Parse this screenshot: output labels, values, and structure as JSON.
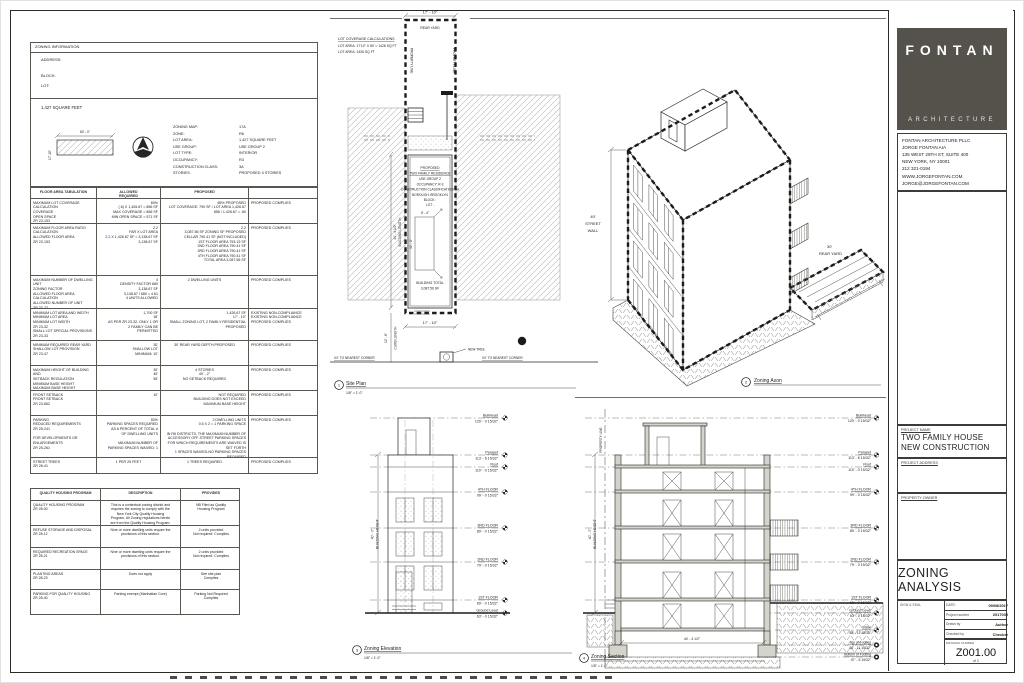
{
  "colors": {
    "logo_box": "#55524b",
    "line": "#2b2b29",
    "hatch": "#b9b9b6"
  },
  "title_block": {
    "logo_word": "FONTAN",
    "logo_sub": "ARCHITECTURE",
    "contact_lines": [
      "FONTAN ARCHITECTURE PLLC",
      "JORGE FONTAN AIA",
      "135 WEST 29TH ST, SUITE 400",
      "NEW YORK, NY 10001",
      "212 321-0194",
      "WWW.JORGEFONTAN.COM",
      "JORGE@JORGEFONTAN.COM"
    ],
    "project_name_label": "PROJECT NAME",
    "project_name1": "TWO FAMILY HOUSE",
    "project_name2": "NEW CONSTRUCTION",
    "project_address_label": "PROJECT ADDRESS",
    "property_owner_label": "PROPERTY OWNER",
    "sheet_title": "ZONING ANALYSIS",
    "seal_label": "SIGN & SEAL",
    "date_label": "DATE:",
    "date_value": "09/08/2017",
    "project_number_label": "Project number",
    "project_number_value": "2017030",
    "drawn_by_label": "Drawn by",
    "drawn_by_value": "Author",
    "checked_by_label": "Checked by",
    "checked_by_value": "Checker",
    "drawing_number_label": "DRAWING NUMBER",
    "drawing_number": "Z001.00",
    "sheet_of": "of 2"
  },
  "zoning_info": {
    "header": "ZONING INFORMATION",
    "address_label": "ADDRESS:",
    "block_label": "BLOCK:",
    "lot_label": "LOT:",
    "lot_area_title": "1,427 SQUARE FEET",
    "lot_dim_top": "80' - 0\"",
    "lot_dim_side": "17'-10\"",
    "fields": [
      {
        "label": "ZONING MAP:",
        "value": "17A"
      },
      {
        "label": "ZONE:",
        "value": "R6"
      },
      {
        "label": "LOT AREA:",
        "value": "1,427 SQUARE FEET"
      },
      {
        "label": "USE GROUP:",
        "value": "USE GROUP 2"
      },
      {
        "label": "LOT TYPE:",
        "value": "INTERIOR"
      },
      {
        "label": "OCCUPANCY:",
        "value": "R3"
      },
      {
        "label": "CONSTRUCTION CLASS:",
        "value": "3A"
      },
      {
        "label": "STORIES:",
        "value": "PROPOSED 4 STORIES"
      }
    ]
  },
  "floor_area_table": {
    "headers": [
      "FLOOR AREA TABULATION",
      "ALLOWED\nREQUIRED",
      "PROPOSED",
      ""
    ],
    "rows": [
      {
        "item": "MAXIMUM LOT COVERAGE\nCALCULATION\nCOVERAGE\nOPEN SPACE\nZR 23-153",
        "allowed": "60%\n(.6) X 1,426.67 = 856 SF\nMAX COVERAGE = 856 SF\nMIN OPEN SPACE = 571 SF",
        "proposed": "65% PROPOSED\nLOT COVERAGE: 790 SF / LOT AREA 1,426.67\n856 / 1,426.67 = .60",
        "status": "PROPOSED COMPLIES"
      },
      {
        "item": "MAXIMUM FLOOR AREA RATIO\nCALCULATION\nALLOWED FLOOR AREA\nZR 23-153",
        "allowed": "2.2\nFAR X LOT AREA\n2.2 X 1,426.67 SF = 3,138.67 SF\n3,138.67 SF",
        "proposed": "2.2\n3,087.56 SF ZONING SF PROPOSED\nCELLAR 790.41 SF (NOT INCLUDED)\n1ST FLOOR AREA 753.13 SF\n2ND FLOOR AREA 790.41 SF\n3RD FLOOR AREA 790.41 SF\n4TH FLOOR AREA 790.41 SF\nTOTAL AREA 3,087.56 SF",
        "status": "PROPOSED COMPLIES"
      },
      {
        "item": "MAXIMUM NUMBER OF DWELLING UNIT\nZONING FACTOR\nALLOWED FLOOR AREA\nCALCULATION\nALLOWED NUMBER OF UNIT\nZR 23-22",
        "allowed": "4\nDENSITY FACTOR 680\n3,138.67 SF\n3,138.67 / 680 = 4.61\n4 UNITS ALLOWED",
        "proposed": "2 DWELLING UNITS",
        "status": "PROPOSED COMPLIES"
      },
      {
        "item": "MINIMUM LOT AREA AND WIDTH\nMINIMUM LOT AREA\nMINIMUM LOT WIDTH\nZR 23-32\nSMALL LOT SPECIAL PROVISIONS\nZR 23-33",
        "allowed": "1,700 SF\n18'\nAS PER ZR 23-32, ONLY 1 OR\n2 FAMILY CAN BE\nPERMITTED",
        "proposed": "1,426.67 SF\n17' - 10\"\nSMALL ZONING LOT, 2 FAMILY RESIDENTIAL\nPROPOSED",
        "status": "EXISTING NON-COMPLIANCE\nEXISTING NON-COMPLIANCE\nPROPOSED COMPLIES"
      },
      {
        "item": "MINIMUM REQUIRED REAR YARD\nSHALLOW LOT PROVISION\nZR 23-47",
        "allowed": "30'\nSHALLOW LOT\nMINIMUM: 10'",
        "proposed": "30' REAR YARD DEPTH PROPOSED",
        "status": "PROPOSED COMPLIES"
      },
      {
        "item": "MAXIMUM HEIGHT OF BUILDING AND\nSETBACK REGULATION\nMINIMUM BASE HEIGHT\nMAXIMUM BASE HEIGHT\nMAXIMUM HEIGHT OF BUILDING\nZR 23-662",
        "allowed": "30'\n45'\n55'",
        "proposed": "4 STORIES\n40' - 2\"\nNO SETBACK REQUIRED",
        "status": "PROPOSED COMPLIES"
      },
      {
        "item": "FRONT SETBACK\nFRONT SETBACK\nZR 23-662",
        "allowed": "10'",
        "proposed": "NOT REQUIRED\nBUILDING DOES NOT EXCEED\nMAXIMUM BASE HEIGHT",
        "status": "PROPOSED COMPLIES"
      },
      {
        "item": "PARKING\nREDUCED REQUIREMENTS\nZR 25-241\n\nFOR DEVELOPMENTS OR\nENLARGEMENTS\nZR 25-261",
        "allowed": "50%\nPARKING SPACES REQUIRED\nAS A PERCENT OF TOTAL #\nOF DWELLING UNITS\n\nMAXIMUM NUMBER OF\nPARKING SPACES WAIVED: 1",
        "proposed": "2 DWELLING UNITS\n0.5 X 2 = 1 PARKING SPACE\n\nIN R6 DISTRICTS, THE MAXIMUM NUMBER OF\nACCESSORY OFF-STREET PARKING SPACES\nFOR WHICH REQUIREMENTS ARE WAIVED IS\nSET FORTH\n1 SPACES WAIVED-NO PARKING SPACES\nREQUIRED",
        "status": "PROPOSED COMPLIES"
      },
      {
        "item": "STREET TREES\nZR 26-41",
        "allowed": "1 PER 25 FEET",
        "proposed": "1 TREES REQUIRED",
        "status": "PROPOSED COMPLIES"
      }
    ]
  },
  "quality_table": {
    "headers": [
      "QUALITY HOUSING PROGRAM",
      "DESCRIPTION",
      "PROVIDED"
    ],
    "rows": [
      {
        "item": "QUALITY HOUSING PROGRAM\nZR 28-00",
        "description": "This is a contextual zoning district and\nrequires the zoning to comply with the\nNew York City Quality Housing\nProgram. All Zoning regulations herein\nare from the Quality Housing Program.",
        "provided": "NB Filed as Quality\nHousing Program"
      },
      {
        "item": "REFUSE STORAGE AND DISPOSAL\nZR 28-12",
        "description": "Nine or more dwelling units require the\nprovisions of this section.",
        "provided": "2 units provided\nNot required. Complies"
      },
      {
        "item": "REQUIRED RECREATION SPACE\nZR 28-21",
        "description": "Nine or more dwelling units require the\nprovisions of this section.",
        "provided": "2 units provided\nNot required. Complies"
      },
      {
        "item": "PLANTING AREAS\nZR 28-23",
        "description": "Does not apply",
        "provided": "See site plan\nComplies"
      },
      {
        "item": "PARKING FOR QUALITY HOUSING\nZR 28-40",
        "description": "Parking exempt (Manhattan Core)",
        "provided": "Parking Not Required\nComplies"
      }
    ]
  },
  "site_plan": {
    "number": "1",
    "title": "Site Plan",
    "scale": "1/8\" = 1'-0\"",
    "calc_lines": [
      "LOT COVERAGE CALCULATIONS",
      "LOT AREA: 17'10\" X 80' = 1426 SQ FT",
      "LOT AREA: 1426 SQ FT"
    ],
    "top_dim": "17' - 10\"",
    "rear_yard": "REAR YARD",
    "prop_line_left": "PROPERTY LINE",
    "prop_line_right": "PROPERTY LINE",
    "building_lines": [
      "PROPOSED",
      "TWO FAMILY RESIDENCE",
      "USE GROUP 2",
      "OCCUPANCY: R-3",
      "CONSTRUCTION CLASSIFICATION: 3A",
      "BOROUGH: BROOKLYN",
      "BLOCK :",
      "LOT :"
    ],
    "room_dim_w": "8' - 4\"",
    "room_dim_h": "32' - 0\"",
    "total_lines": [
      "BUILDING TOTAL",
      "3,087.56 SF"
    ],
    "bottom_dim": "17' - 10\"",
    "length_dim": "44' - 4 1/2\"",
    "length_label": "BUILDING LENGTH",
    "curb_label": "CURB LENGTH",
    "curb_dim": "12' - 6\"",
    "tree_label": "NEW TREE",
    "corner_left": "XX' TO NEAREST CORNER",
    "corner_right": "XX' TO NEAREST CORNER"
  },
  "axon": {
    "number": "2",
    "title": "Zoning Axon",
    "street_wall_lines": [
      "40'",
      "STREET",
      "WALL"
    ],
    "rear_yard_lines": [
      "30'",
      "REAR YARD"
    ]
  },
  "elevation": {
    "number": "3",
    "title": "Zoning Elevation",
    "scale": "1/8\" = 1'-0\"",
    "height_dim": "40' - 0\"",
    "height_label": "BUILDING HEIGHT",
    "levels": [
      {
        "name": "Bulkhead",
        "elev": "120' - 0 15/32\""
      },
      {
        "name": "Parapet",
        "elev": "113' - 6 15/32\""
      },
      {
        "name": "Roof",
        "elev": "110' - 0 15/32\""
      },
      {
        "name": "4TH FLOOR",
        "elev": "99' - 0 15/32\""
      },
      {
        "name": "3RD FLOOR",
        "elev": "89' - 0 15/32\""
      },
      {
        "name": "2ND FLOOR",
        "elev": "79' - 0 15/32\""
      },
      {
        "name": "1ST FLOOR",
        "elev": "69' - 0 15/32\""
      },
      {
        "name": "Ground Level",
        "elev": "63' - 0 15/32\""
      }
    ]
  },
  "section": {
    "number": "4",
    "title": "Zoning Section",
    "scale": "1/8\" = 1'-0\"",
    "height_dim": "40' - 0\"",
    "height_label": "BUILDING HEIGHT",
    "property_line": "PROPERTY LINE",
    "bottom_dim": "44' - 4 1/2\"",
    "levels": [
      {
        "name": "Bulkhead",
        "elev": "120' - 0 15/32\""
      },
      {
        "name": "Parapet",
        "elev": "113' - 6 15/32\""
      },
      {
        "name": "Roof",
        "elev": "110' - 0 15/32\""
      },
      {
        "name": "4TH FLOOR",
        "elev": "99' - 0 15/32\""
      },
      {
        "name": "3RD FLOOR",
        "elev": "89' - 0 15/32\""
      },
      {
        "name": "2ND FLOOR",
        "elev": "79' - 0 15/32\""
      },
      {
        "name": "1ST FLOOR",
        "elev": "69' - 0 15/32\""
      },
      {
        "name": "Ground Level",
        "elev": "63' - 0 15/32\""
      },
      {
        "name": "Cellar",
        "elev": "58' - 11 15/32\""
      },
      {
        "name": "Top of Footing",
        "elev": "58' - 11 15/32\""
      },
      {
        "name": "Bottom of Footing",
        "elev": "57' - 5 15/32\""
      }
    ]
  }
}
